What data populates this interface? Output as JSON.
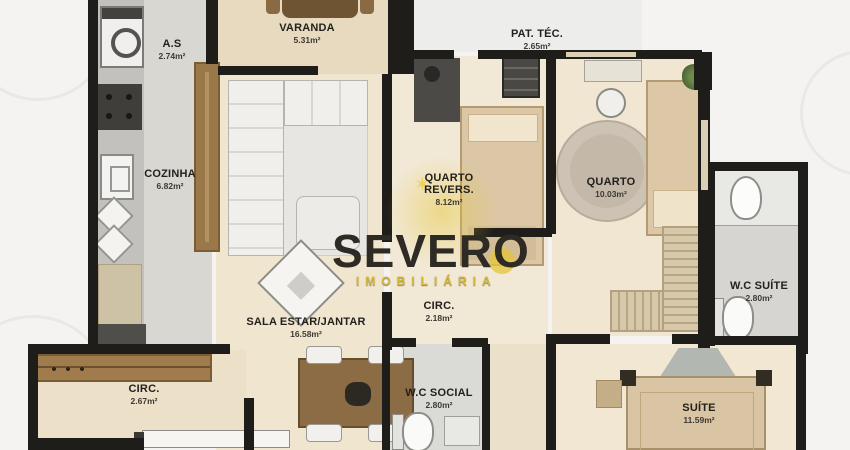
{
  "watermark": {
    "brand": "SEVERO",
    "subtitle": "IMOBILIÁRIA",
    "star": "✶"
  },
  "rooms": [
    {
      "id": "as",
      "name": "A.S",
      "area": "2.74m²"
    },
    {
      "id": "varanda",
      "name": "VARANDA",
      "area": "5.31m²"
    },
    {
      "id": "pat-tec",
      "name": "PAT. TÉC.",
      "area": "2.65m²"
    },
    {
      "id": "cozinha",
      "name": "COZINHA",
      "area": "6.82m²"
    },
    {
      "id": "quarto-revers",
      "name": "QUARTO REVERS.",
      "area": "8.12m²"
    },
    {
      "id": "quarto",
      "name": "QUARTO",
      "area": "10.03m²"
    },
    {
      "id": "wc-suite",
      "name": "W.C SUÍTE",
      "area": "2.80m²"
    },
    {
      "id": "sala",
      "name": "SALA ESTAR/JANTAR",
      "area": "16.58m²"
    },
    {
      "id": "circ-centro",
      "name": "CIRC.",
      "area": "2.18m²"
    },
    {
      "id": "circ-entrada",
      "name": "CIRC.",
      "area": "2.67m²"
    },
    {
      "id": "wc-social",
      "name": "W.C SOCIAL",
      "area": "2.80m²"
    },
    {
      "id": "suite",
      "name": "SUÍTE",
      "area": "11.59m²"
    }
  ],
  "colors": {
    "wall": "#1f1d1a",
    "floor_cream": "#f0e6d0",
    "floor_balcony": "#e8dabf",
    "floor_tile_gray": "#d6d5d2",
    "wood": "#9a784a",
    "bedspread": "#dbc7a5",
    "watermark_dark": "#2e2b24",
    "watermark_yellow": "#d7b838"
  }
}
